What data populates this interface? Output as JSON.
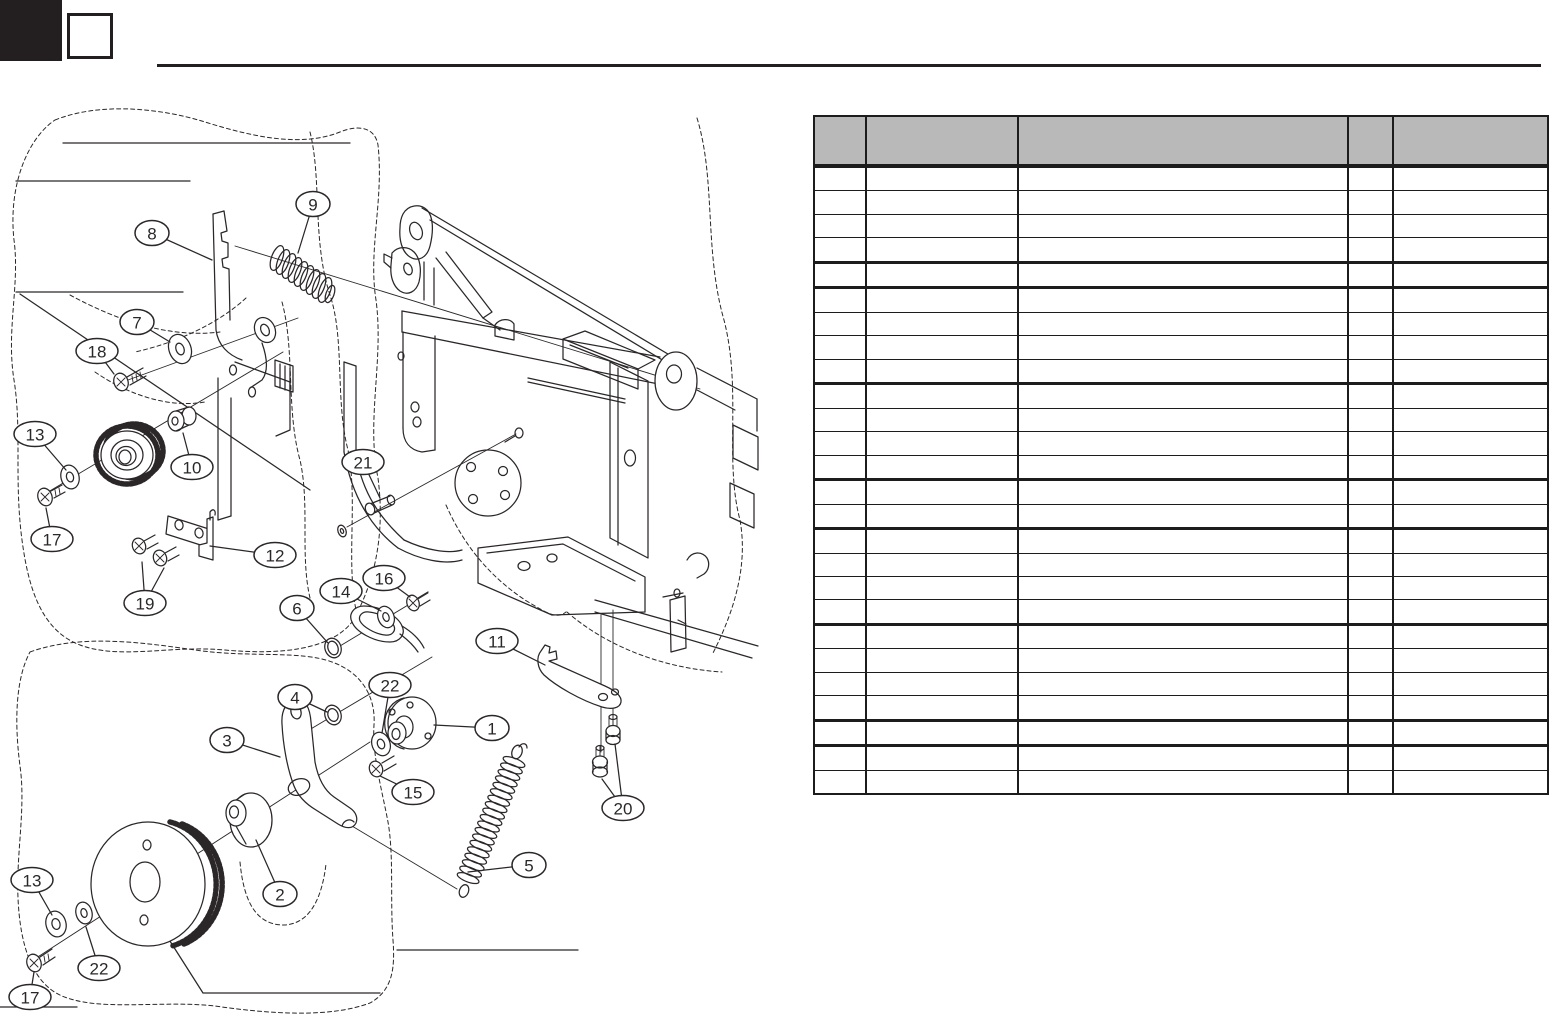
{
  "page": {
    "background": "#ffffff",
    "ink": "#2b2728"
  },
  "header_mark": {
    "corner_block_color": "#231f20",
    "section_box_text": ""
  },
  "table": {
    "left": 813,
    "top": 115,
    "width": 736,
    "height": 680,
    "header_height": 47,
    "header_bg": "#b9b9b9",
    "border_color": "#1c1c1c",
    "col_widths": [
      52,
      153,
      332,
      45,
      154
    ],
    "header_labels": [
      "",
      "",
      "",
      "",
      ""
    ],
    "row_count": 26,
    "thick_after_rows": [
      4,
      5,
      9,
      13,
      15,
      19,
      23,
      24
    ],
    "cells": "empty"
  },
  "diagram": {
    "balloon_ry": 12.5,
    "balloon_font_px": 17,
    "callouts": [
      {
        "label": "9",
        "cx": 313,
        "cy": 204,
        "leaders": [
          [
            298,
            253
          ]
        ]
      },
      {
        "label": "8",
        "cx": 152,
        "cy": 233,
        "leaders": [
          [
            212,
            260
          ]
        ]
      },
      {
        "label": "7",
        "cx": 137,
        "cy": 322,
        "leaders": [
          [
            170,
            342
          ]
        ]
      },
      {
        "label": "18",
        "cx": 97,
        "cy": 351,
        "leaders": [
          [
            114,
            374
          ]
        ]
      },
      {
        "label": "13",
        "cx": 35,
        "cy": 434,
        "leaders": [
          [
            66,
            470
          ]
        ]
      },
      {
        "label": "10",
        "cx": 192,
        "cy": 467,
        "leaders": [
          [
            183,
            433
          ]
        ]
      },
      {
        "label": "21",
        "cx": 363,
        "cy": 462,
        "leaders": [
          [
            380,
            498
          ]
        ]
      },
      {
        "label": "17",
        "cx": 52,
        "cy": 539,
        "leaders": [
          [
            46,
            508
          ]
        ]
      },
      {
        "label": "12",
        "cx": 275,
        "cy": 555,
        "leaders": [
          [
            210,
            546
          ]
        ]
      },
      {
        "label": "19",
        "cx": 145,
        "cy": 603,
        "leaders": [
          [
            142,
            562
          ],
          [
            164,
            568
          ]
        ]
      },
      {
        "label": "6",
        "cx": 297,
        "cy": 608,
        "leaders": [
          [
            328,
            643
          ]
        ]
      },
      {
        "label": "14",
        "cx": 341,
        "cy": 591,
        "leaders": [
          [
            381,
            611
          ]
        ]
      },
      {
        "label": "16",
        "cx": 384,
        "cy": 578,
        "leaders": [
          [
            410,
            597
          ]
        ]
      },
      {
        "label": "11",
        "cx": 497,
        "cy": 641,
        "leaders": [
          [
            545,
            665
          ]
        ]
      },
      {
        "label": "4",
        "cx": 295,
        "cy": 697,
        "leaders": [
          [
            327,
            712
          ]
        ]
      },
      {
        "label": "22",
        "cx": 390,
        "cy": 685,
        "leaders": [
          [
            382,
            733
          ]
        ]
      },
      {
        "label": "3",
        "cx": 227,
        "cy": 740,
        "leaders": [
          [
            280,
            757
          ]
        ]
      },
      {
        "label": "1",
        "cx": 492,
        "cy": 728,
        "leaders": [
          [
            434,
            725
          ]
        ]
      },
      {
        "label": "15",
        "cx": 413,
        "cy": 792,
        "leaders": [
          [
            380,
            776
          ]
        ]
      },
      {
        "label": "5",
        "cx": 529,
        "cy": 865,
        "leaders": [
          [
            468,
            872
          ]
        ]
      },
      {
        "label": "20",
        "cx": 623,
        "cy": 808,
        "leaders": [
          [
            602,
            779
          ],
          [
            615,
            744
          ]
        ]
      },
      {
        "label": "2",
        "cx": 280,
        "cy": 894,
        "leaders": [
          [
            256,
            840
          ]
        ]
      },
      {
        "label": "13",
        "cx": 32,
        "cy": 880,
        "leaders": [
          [
            52,
            915
          ]
        ]
      },
      {
        "label": "22",
        "cx": 99,
        "cy": 968,
        "leaders": [
          [
            86,
            927
          ]
        ]
      },
      {
        "label": "17",
        "cx": 30,
        "cy": 997,
        "leaders": [
          [
            34,
            972
          ]
        ]
      }
    ]
  }
}
